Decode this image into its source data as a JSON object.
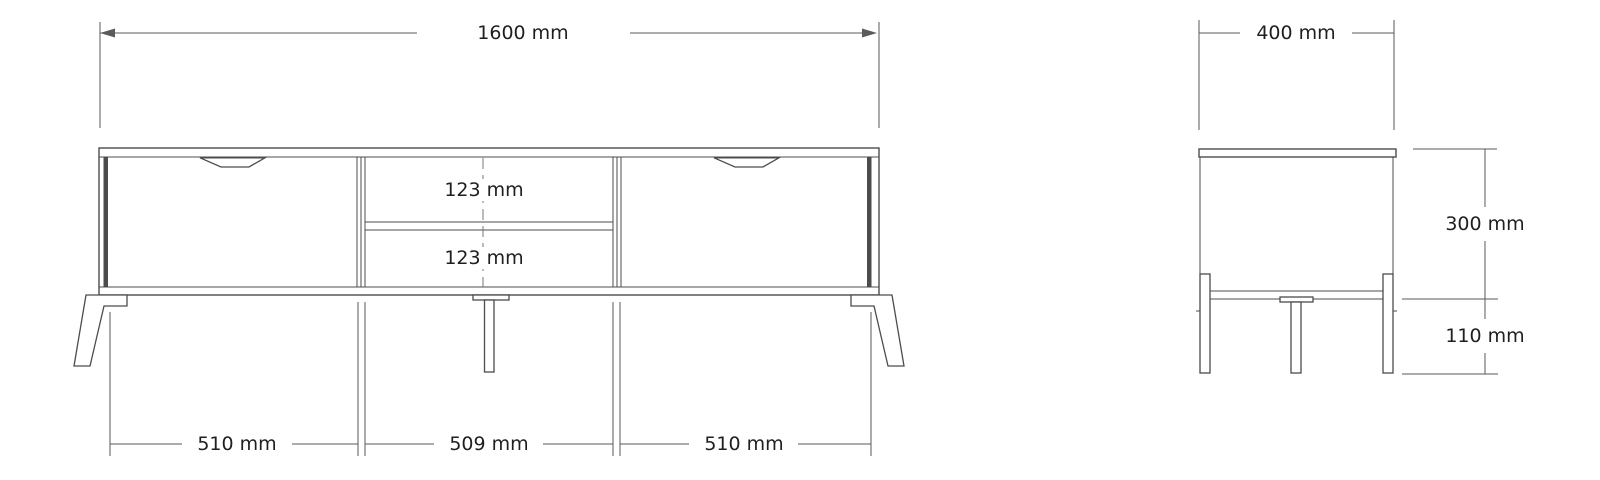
{
  "front_view": {
    "dimensions": {
      "total_width": "1600 mm",
      "upper_shelf_height": "123 mm",
      "lower_shelf_height": "123 mm",
      "left_door_width": "510 mm",
      "middle_section_width": "509 mm",
      "right_door_width": "510 mm"
    }
  },
  "side_view": {
    "dimensions": {
      "depth": "400 mm",
      "body_height": "300 mm",
      "leg_height": "110 mm"
    }
  },
  "colors": {
    "background": "#ffffff",
    "line": "#4c4c4c",
    "dim_line": "#5a5a5a",
    "text": "#1f1f1f"
  }
}
